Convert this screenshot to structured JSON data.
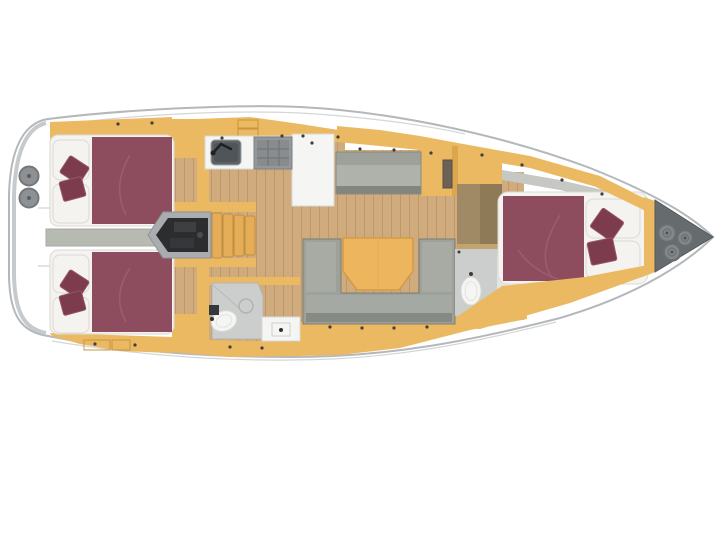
{
  "canvas": {
    "width": 720,
    "height": 540,
    "background": "#ffffff"
  },
  "scene": {
    "type": "yacht-floor-plan",
    "view": "top-down",
    "orientation": "bow-right-stern-left",
    "compartments": [
      {
        "name": "aft-cabin-port",
        "features": [
          "double-berth",
          "maroon-bedding",
          "pillows",
          "wardrobe",
          "lockers"
        ]
      },
      {
        "name": "aft-cabin-starboard",
        "features": [
          "double-berth",
          "maroon-bedding",
          "pillows",
          "wardrobe",
          "lockers"
        ]
      },
      {
        "name": "aft-walkway",
        "features": [
          "corridor-between-aft-cabins"
        ]
      },
      {
        "name": "companionway",
        "features": [
          "wooden-steps",
          "engine-compartment"
        ]
      },
      {
        "name": "galley",
        "features": [
          "sink",
          "faucet",
          "stove",
          "counter",
          "cabinet-column"
        ]
      },
      {
        "name": "aft-head",
        "features": [
          "toilet",
          "shower-drain",
          "vanity"
        ]
      },
      {
        "name": "salon",
        "features": [
          "side-sofa",
          "u-shaped-sofa",
          "folding-table"
        ]
      },
      {
        "name": "forward-head",
        "features": [
          "toilet",
          "vanity"
        ]
      },
      {
        "name": "forward-cabin",
        "features": [
          "double-berth",
          "maroon-bedding",
          "pillows",
          "shelf"
        ]
      },
      {
        "name": "bow-locker",
        "features": [
          "rope-coils"
        ]
      },
      {
        "name": "stern-platform",
        "features": [
          "deck-fittings"
        ]
      }
    ]
  },
  "colors": {
    "hull_fill": "#ffffff",
    "hull_outline": "#b4b8bb",
    "hull_inner_line": "#d3d6d8",
    "deck_shading": "#c7cacc",
    "furniture_yellow": "#ecb963",
    "furniture_yellow_dark": "#dca64d",
    "wood_floor": "#cfab7e",
    "wood_plank_line": "#c09868",
    "bed_maroon": "#8d4d5f",
    "pillow_maroon": "#7c3c4e",
    "linen_white": "#f4f3ef",
    "sofa_gray": "#9da19a",
    "table_orange": "#eeb55f",
    "corridor_gray": "#b7bab1",
    "engine_black": "#2b2d2f",
    "engine_casing": "#a9adaf",
    "steps_wood": "#e5ad57",
    "sink_gray": "#5d6266",
    "stove_gray": "#94989b",
    "bath_floor": "#cbcecc",
    "fixture_white": "#f5f6f3",
    "panel_brown": "#a08a66",
    "panel_brown_dark": "#8f7a58",
    "bow_locker_gray": "#666b6e",
    "rope_gray": "#82878a",
    "deck_fitting_gray": "#8d9194",
    "detail_dot": "#3f3f3b"
  }
}
